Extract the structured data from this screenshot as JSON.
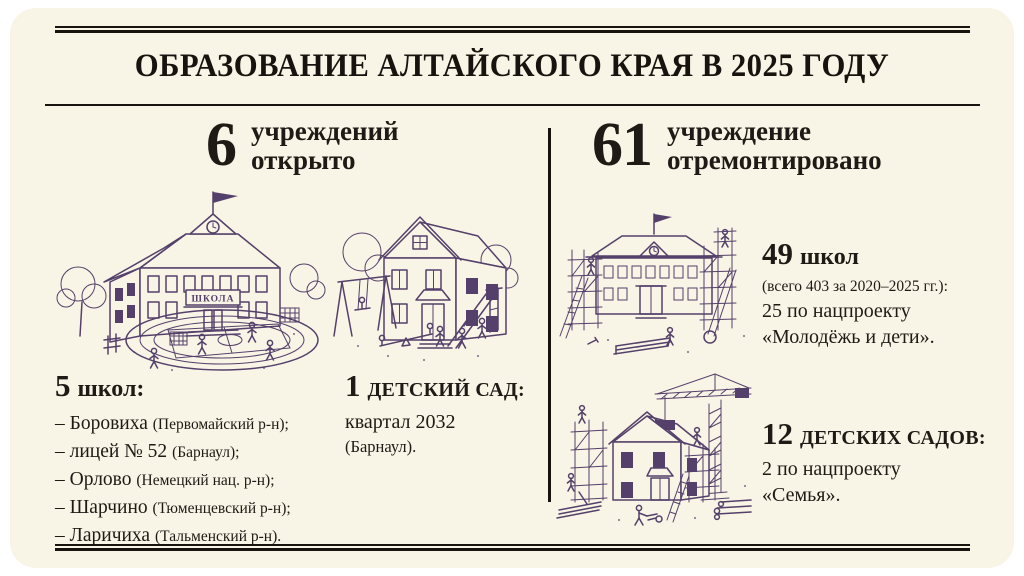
{
  "header": {
    "title": "ОБРАЗОВАНИЕ АЛТАЙСКОГО КРАЯ В 2025 ГОДУ"
  },
  "opened": {
    "number": "6",
    "label_line1": "учреждений",
    "label_line2": "открыто",
    "school_sign": "ШКОЛА",
    "schools": {
      "count": "5",
      "heading": "школ:",
      "items": [
        {
          "name": "– Боровиха",
          "note": "(Первомайский р-н);"
        },
        {
          "name": "– лицей № 52",
          "note": "(Барнаул);"
        },
        {
          "name": "– Орлово",
          "note": "(Немецкий нац. р-н);"
        },
        {
          "name": "– Шарчино",
          "note": "(Тюменцевский р-н);"
        },
        {
          "name": "– Ларичиха",
          "note": "(Тальменский р-н)."
        }
      ]
    },
    "kindergarten": {
      "count": "1",
      "heading": "детский сад:",
      "line1": "квартал 2032",
      "line2": "(Барнаул)."
    }
  },
  "renovated": {
    "number": "61",
    "label_line1": "учреждение",
    "label_line2": "отремонтировано",
    "schools": {
      "count": "49",
      "heading": "школ",
      "note": "(всего 403 за 2020–2025 гг.):",
      "line1": "25 по нацпроекту",
      "line2": "«Молодёжь и дети»."
    },
    "kindergartens": {
      "count": "12",
      "heading": "детских садов:",
      "line1": "2 по нацпроекту",
      "line2": "«Семья»."
    }
  },
  "colors": {
    "card_background": "#f8f4e6",
    "ink": "#17140f",
    "illustration": "#54406a"
  }
}
